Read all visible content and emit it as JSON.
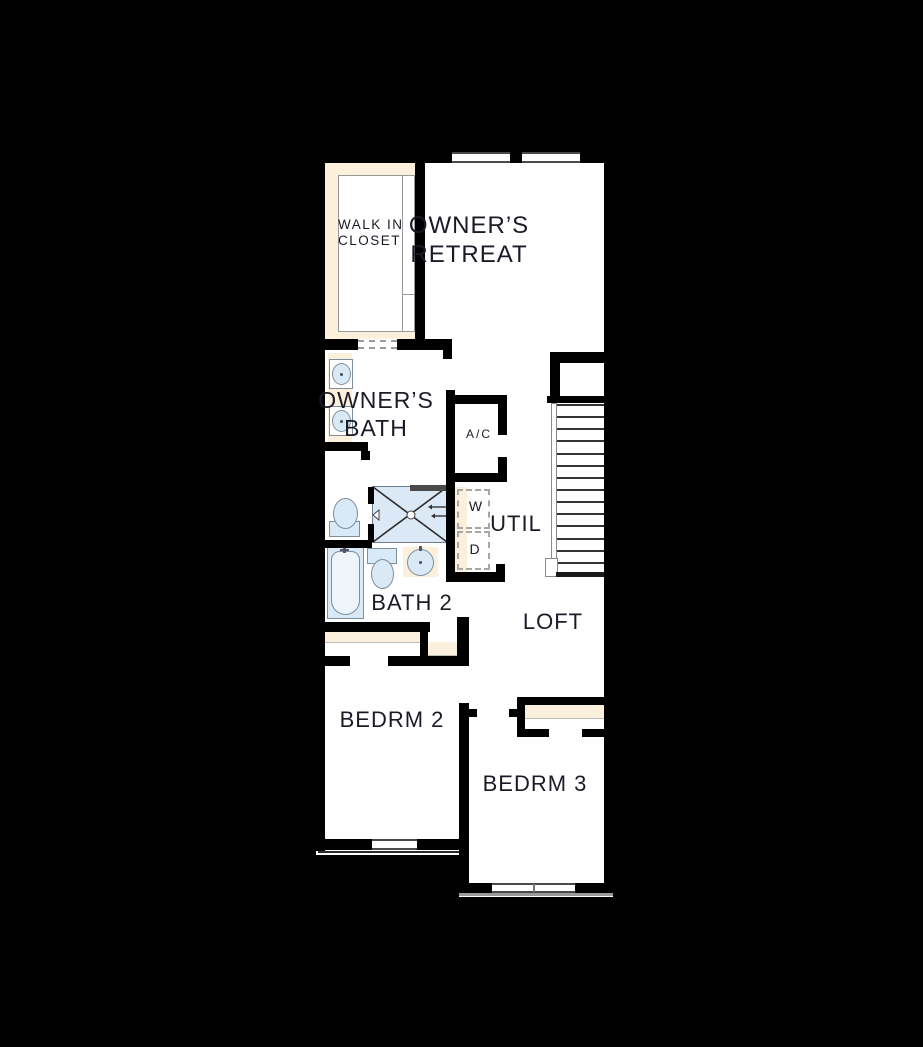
{
  "floorplan": {
    "rooms": {
      "walk_in_closet": {
        "line1": "WALK IN",
        "line2": "CLOSET"
      },
      "owners_retreat": {
        "line1": "OWNER’S",
        "line2": "RETREAT"
      },
      "owners_bath": {
        "line1": "OWNER’S",
        "line2": "BATH"
      },
      "ac": {
        "label": "A/C"
      },
      "util": {
        "label": "UTIL"
      },
      "washer": {
        "label": "W"
      },
      "dryer": {
        "label": "D"
      },
      "bath2": {
        "label": "BATH 2"
      },
      "loft": {
        "label": "LOFT"
      },
      "bedroom2": {
        "label": "BEDRM 2"
      },
      "bedroom3": {
        "label": "BEDRM 3"
      }
    },
    "stairs": {
      "tread_count": 15
    },
    "colors": {
      "background": "#000000",
      "wall": "#000000",
      "floor": "#ffffff",
      "cream": "#faf0dc",
      "fixture_fill": "#d9e9f5",
      "fixture_border": "#7d8f9e",
      "line_gray": "#999999",
      "text": "#1b1b28"
    }
  }
}
